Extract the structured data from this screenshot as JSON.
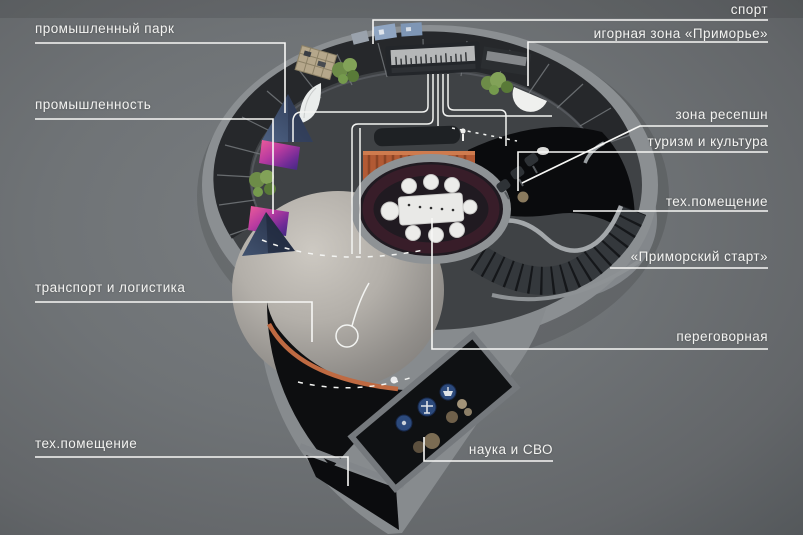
{
  "scene": {
    "description": "Top-down 3D floor plan of a circular exhibition pavilion with zone callout labels",
    "language": "ru"
  },
  "colors": {
    "background": "#6f7376",
    "label_text": "#f3f3f1",
    "callout_line": "#f7f7f5",
    "outer_wall": "#8b8f92",
    "stands_band": "#26282b",
    "main_floor": "#3f4245",
    "light_floor": "#c0bcb5",
    "black_rooms": "#0c0d0f",
    "accent_orange": "#b55a34",
    "accent_magenta": "#b93ba0",
    "accent_navy": "#3c4c6c",
    "plant_green": "#6d8c48",
    "table_white": "#e9e9e7",
    "icon_blue": "#2c4a7c",
    "meeting_room_floor": "#201a21"
  },
  "labels": {
    "left": [
      {
        "text": "промышленный парк"
      },
      {
        "text": "промышленность"
      },
      {
        "text": "транспорт и логистика"
      },
      {
        "text": "тех.помещение"
      }
    ],
    "right": [
      {
        "text": "спорт"
      },
      {
        "text": "игорная зона «Приморье»"
      },
      {
        "text": "зона ресепшн"
      },
      {
        "text": "туризм и культура"
      },
      {
        "text": "тех.помещение"
      },
      {
        "text": "«Приморский старт»"
      },
      {
        "text": "переговорная"
      }
    ],
    "bottom": [
      {
        "text": "наука и СВО"
      }
    ]
  },
  "plan": {
    "zones": [
      "промышленный парк",
      "промышленность",
      "транспорт и логистика",
      "тех.помещение",
      "спорт",
      "игорная зона «Приморье»",
      "зона ресепшн",
      "туризм и культура",
      "«Приморский старт»",
      "переговорная",
      "наука и СВО"
    ],
    "icons": [
      "airplane-icon",
      "ship-icon",
      "anchor-dot-icon",
      "person-icon"
    ],
    "features": [
      "circular exhibition ring of stands",
      "video wall stand",
      "oval meeting room with white table and 8 chairs",
      "orange info desk",
      "reception desk",
      "spiral staircase",
      "white walking path lines",
      "magenta media screens",
      "navy sail displays",
      "plants",
      "science room with round exhibit icons"
    ]
  }
}
